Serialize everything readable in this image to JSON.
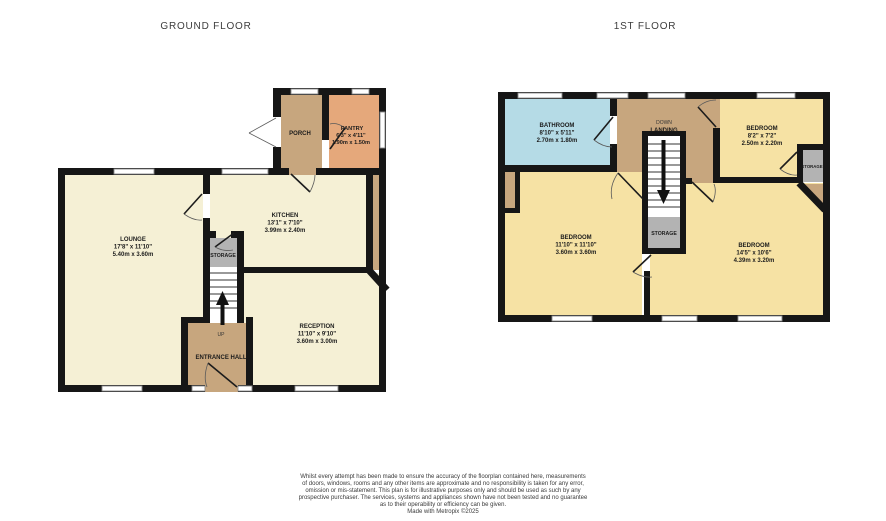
{
  "colors": {
    "wall": "#161616",
    "room_cream": "#f5f0d5",
    "room_yellow": "#f6e2a4",
    "hall_tan": "#c7a67e",
    "pantry_orange": "#e5a87b",
    "bathroom_blue": "#b5dbe6",
    "storage_gray": "#b3b3b3"
  },
  "titles": {
    "ground": "GROUND FLOOR",
    "first": "1ST FLOOR"
  },
  "ground_floor": {
    "lounge": {
      "name": "LOUNGE",
      "dims_ft": "17'8\" x 11'10\"",
      "dims_m": "5.40m x 3.60m"
    },
    "kitchen": {
      "name": "KITCHEN",
      "dims_ft": "13'1\" x 7'10\"",
      "dims_m": "3.99m x 2.40m"
    },
    "pantry": {
      "name": "PANTRY",
      "dims_ft": "6'3\" x 4'11\"",
      "dims_m": "1.90m x 1.50m"
    },
    "porch": {
      "name": "PORCH"
    },
    "reception": {
      "name": "RECEPTION",
      "dims_ft": "11'10\" x 9'10\"",
      "dims_m": "3.60m x 3.00m"
    },
    "entrance_hall": {
      "name": "ENTRANCE HALL"
    },
    "storage": {
      "name": "STORAGE"
    },
    "stair_direction": "UP"
  },
  "first_floor": {
    "bathroom": {
      "name": "BATHROOM",
      "dims_ft": "8'10\" x 5'11\"",
      "dims_m": "2.70m x 1.80m"
    },
    "landing": {
      "name": "LANDING",
      "direction": "DOWN"
    },
    "bedroom_small": {
      "name": "BEDROOM",
      "dims_ft": "8'2\" x 7'2\"",
      "dims_m": "2.50m x 2.20m"
    },
    "bedroom_left": {
      "name": "BEDROOM",
      "dims_ft": "11'10\" x 11'10\"",
      "dims_m": "3.60m x 3.60m"
    },
    "bedroom_right": {
      "name": "BEDROOM",
      "dims_ft": "14'5\" x 10'6\"",
      "dims_m": "4.39m x 3.20m"
    },
    "storage_mid": {
      "name": "STORAGE"
    },
    "storage_right": {
      "name": "STORAGE"
    }
  },
  "disclaimer": {
    "line1": "Whilst every attempt has been made to ensure the accuracy of the floorplan contained here, measurements",
    "line2": "of doors, windows, rooms and any other items are approximate and no responsibility is taken for any error,",
    "line3": "omission or mis-statement. This plan is for illustrative purposes only and should be used as such by any",
    "line4": "prospective purchaser. The services, systems and appliances shown have not been tested and no guarantee",
    "line5": "as to their operability or efficiency can be given.",
    "line6": "Made with Metropix ©2025"
  }
}
